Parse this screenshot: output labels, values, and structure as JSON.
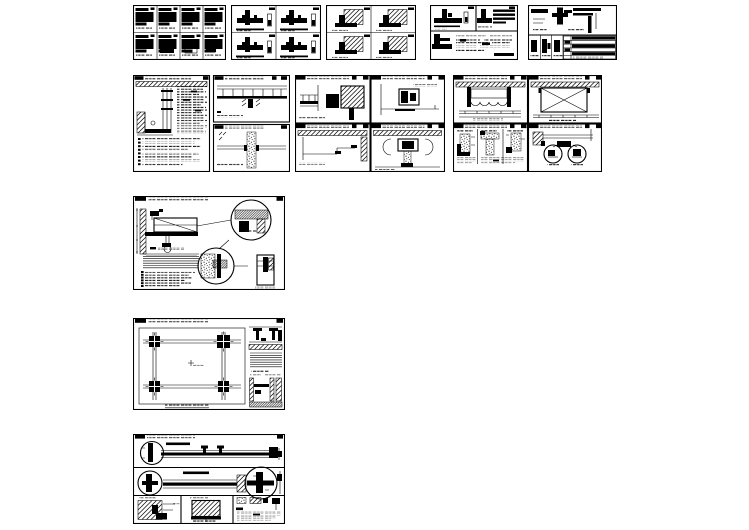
{
  "page": {
    "background": "#ffffff",
    "ink": "#000000"
  },
  "sheets": [
    {
      "id": "r1c1",
      "alt": "detail sheet with eight framed node details"
    },
    {
      "id": "r1c2",
      "alt": "detail sheet with four mullion joint details"
    },
    {
      "id": "r1c3",
      "alt": "detail sheet with four hatched corner details"
    },
    {
      "id": "r1c4",
      "alt": "detail sheet with two joint details over a notes panel"
    },
    {
      "id": "r1c5",
      "alt": "detail sheet with joint detail and parts schedule table"
    },
    {
      "id": "r2c1",
      "alt": "ceiling detail sheet with section, notes column and two stacked details"
    },
    {
      "id": "r2c2",
      "alt": "ceiling detail sheet with four curtain box and cove details"
    },
    {
      "id": "r2c3",
      "alt": "ceiling detail sheet with valance, access panel and stone details"
    },
    {
      "id": "r3c1",
      "alt": "counter and sink detail sheet with enlarged circle callouts"
    },
    {
      "id": "r4c1",
      "alt": "ceiling plan detail sheet with corner assemblies and side sections"
    },
    {
      "id": "r5c1",
      "alt": "track assembly detail sheet with circle callouts and notes block"
    }
  ]
}
